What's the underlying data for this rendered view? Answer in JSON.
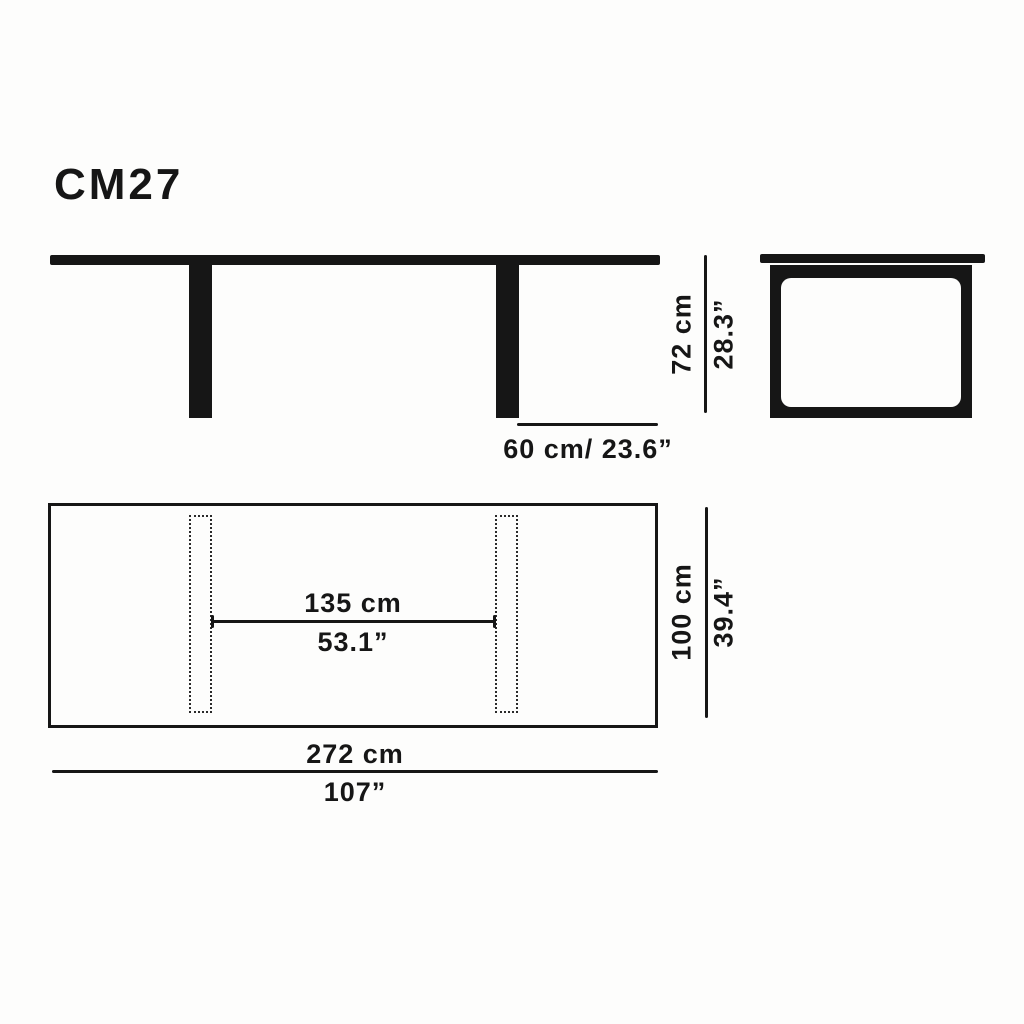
{
  "title": "CM27",
  "colors": {
    "ink": "#161616",
    "paper": "#fdfdfc"
  },
  "dimensions": {
    "height_cm": "72 cm",
    "height_in": "28.3”",
    "overhang": "60 cm/ 23.6”",
    "leg_span_cm": "135 cm",
    "leg_span_in": "53.1”",
    "depth_cm": "100 cm",
    "depth_in": "39.4”",
    "length_cm": "272 cm",
    "length_in": "107”"
  }
}
